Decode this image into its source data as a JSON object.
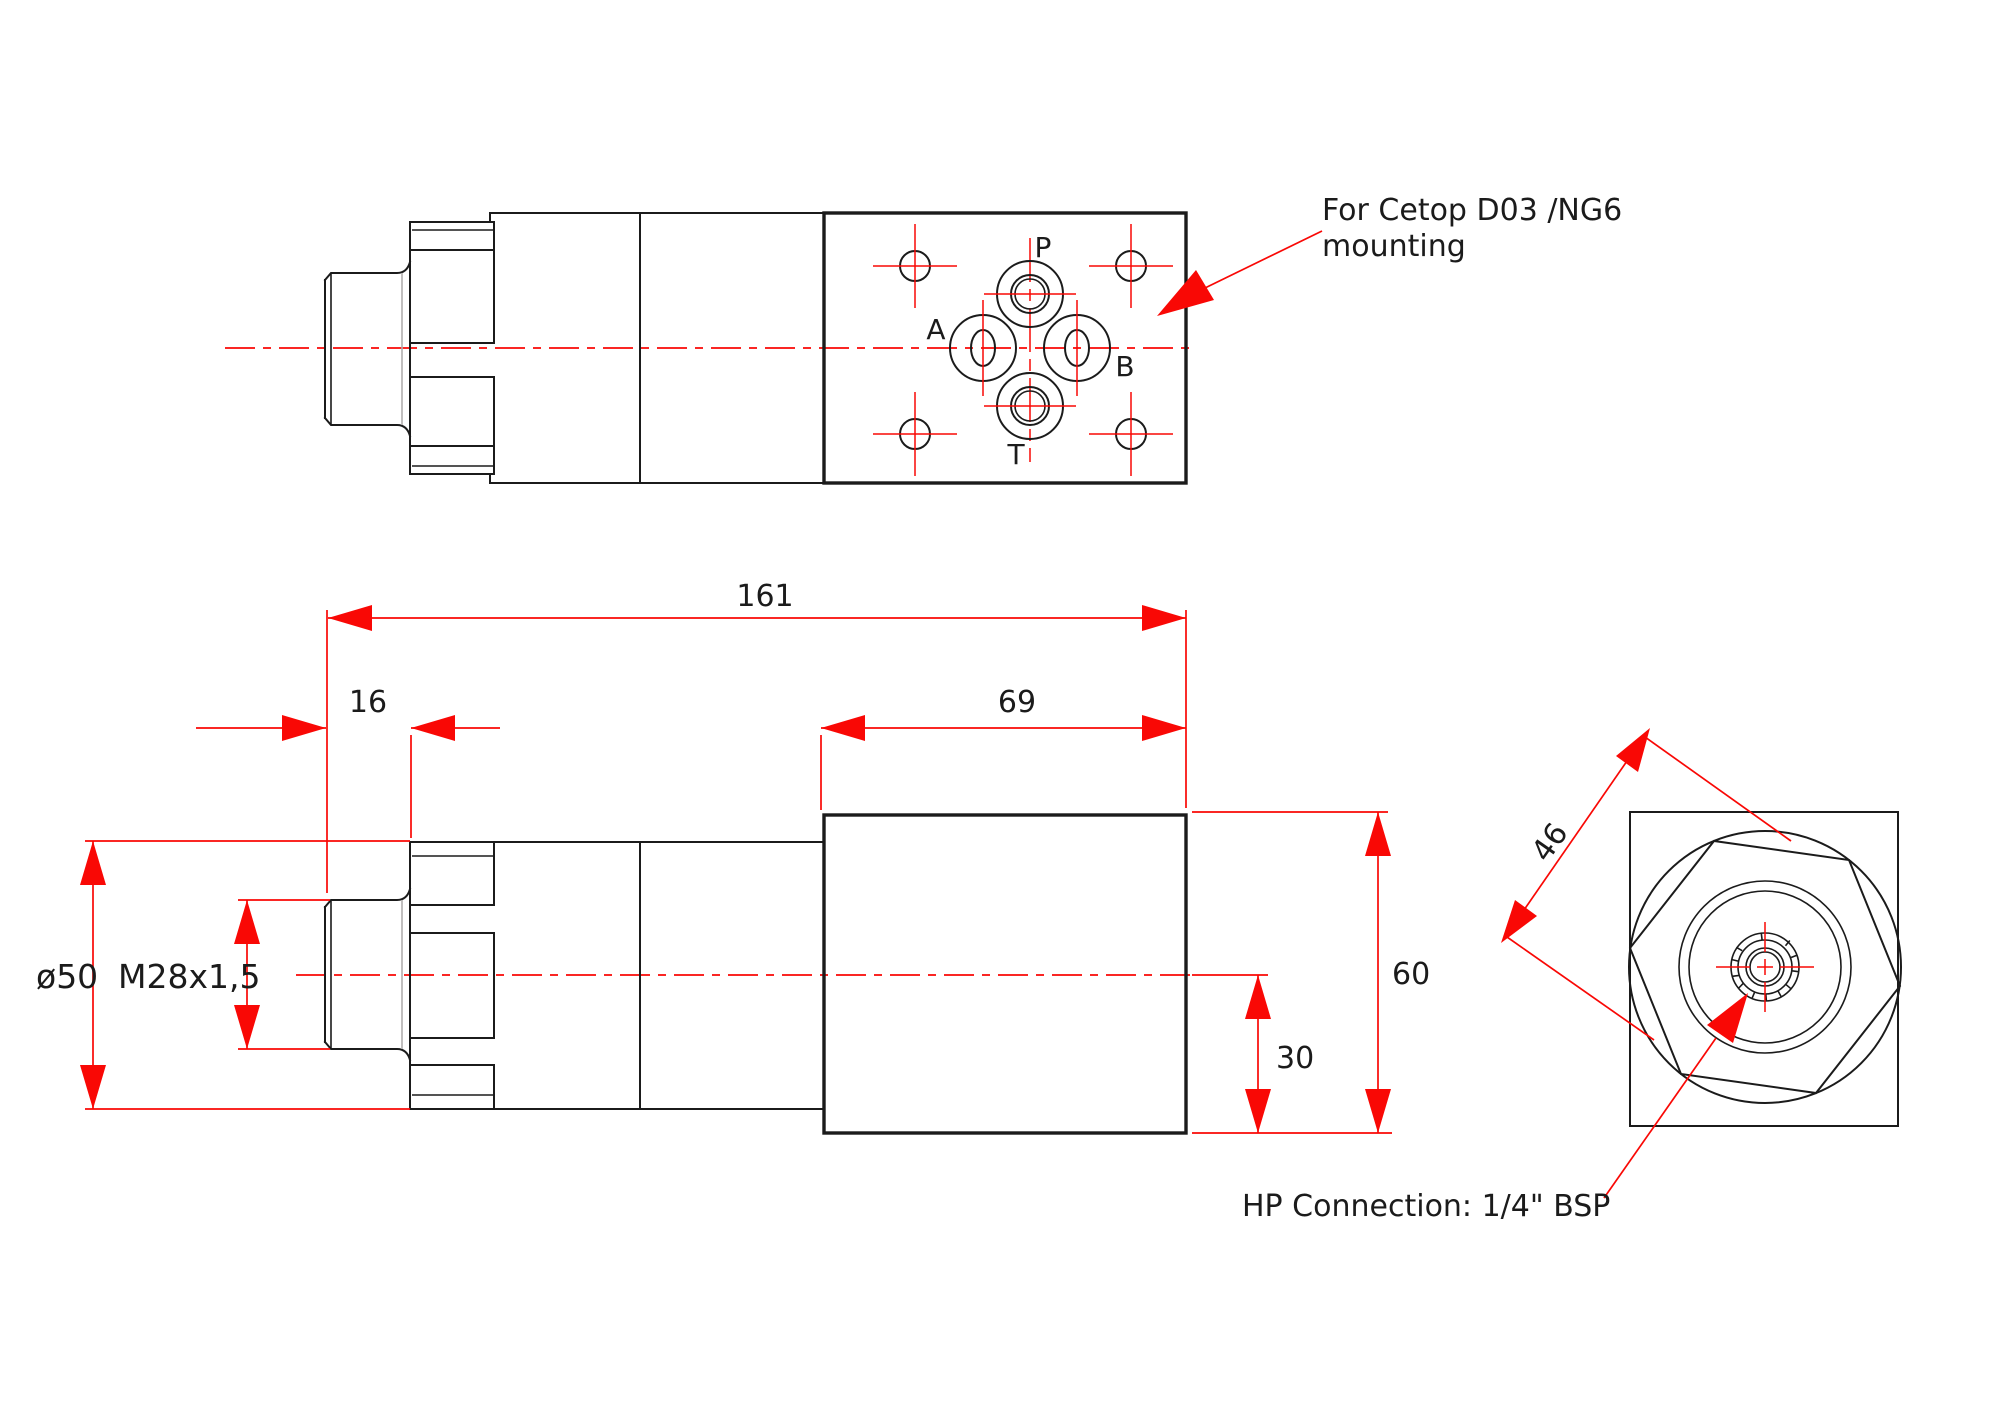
{
  "drawing": {
    "annotations": {
      "mounting_note_line1": "For Cetop D03 /NG6",
      "mounting_note_line2": "mounting",
      "hp_connection_note": "HP Connection: 1/4\" BSP"
    },
    "ports": {
      "p": "P",
      "a": "A",
      "b": "B",
      "t": "T"
    },
    "dimensions": {
      "overall_length": "161",
      "plug_length": "16",
      "solenoid_length": "69",
      "flange_diameter": "ø50",
      "thread_spec": "M28x1,5",
      "solenoid_height": "60",
      "half_height": "30",
      "across_flats": "46"
    },
    "colors": {
      "dimension_red": "#f90805",
      "line_black": "#1b1b1b"
    }
  }
}
